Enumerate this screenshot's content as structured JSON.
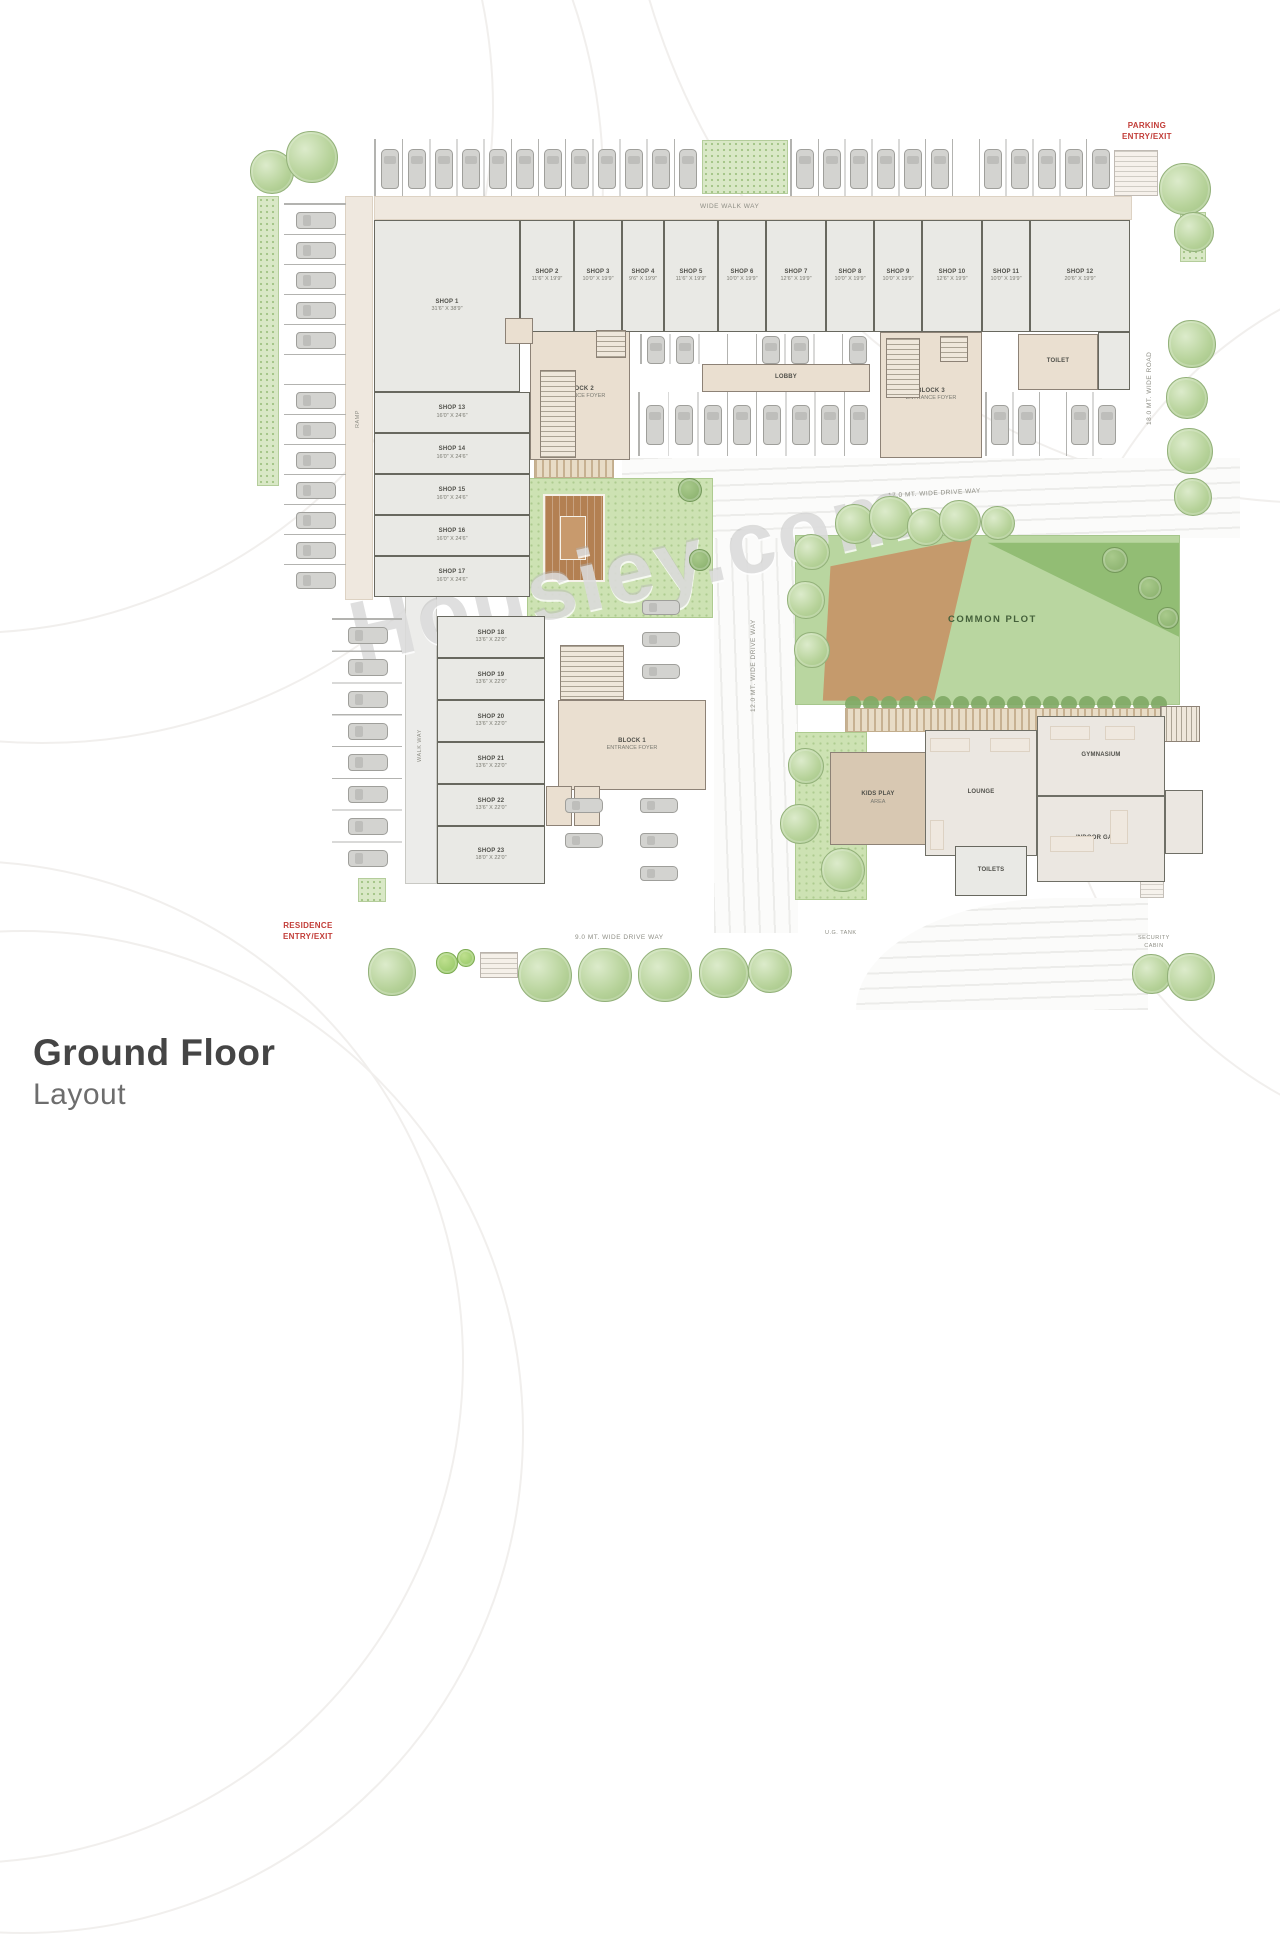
{
  "header": {
    "title": "Ground Floor",
    "subtitle": "Layout"
  },
  "watermark": "Housiey.com",
  "annotations": {
    "entry_top_right_line1": "PARKING",
    "entry_top_right_line2": "ENTRY/EXIT",
    "entry_bottom_left_line1": "RESIDENCE",
    "entry_bottom_left_line2": "ENTRY/EXIT",
    "walkway_top": "WIDE WALK WAY",
    "drive_17": "17.0 MT. WIDE DRIVE WAY",
    "drive_12": "12.0 MT. WIDE DRIVE WAY",
    "drive_9": "9.0 MT. WIDE DRIVE WAY",
    "road_18": "18.0 MT. WIDE ROAD",
    "ramp_left": "RAMP",
    "walk_left": "WALK WAY",
    "ug_tank": "U.G. TANK",
    "security_line1": "SECURITY",
    "security_line2": "CABIN",
    "common_plot": "COMMON PLOT"
  },
  "rooms": {
    "shop1": {
      "name": "SHOP 1",
      "dims": "31'6\" X 38'9\""
    },
    "shop2": {
      "name": "SHOP 2",
      "dims": "11'6\" X 19'9\""
    },
    "shop3": {
      "name": "SHOP 3",
      "dims": "10'0\" X 19'9\""
    },
    "shop4": {
      "name": "SHOP 4",
      "dims": "9'6\" X 19'9\""
    },
    "shop5": {
      "name": "SHOP 5",
      "dims": "11'6\" X 19'9\""
    },
    "shop6": {
      "name": "SHOP 6",
      "dims": "10'0\" X 19'9\""
    },
    "shop7": {
      "name": "SHOP 7",
      "dims": "12'6\" X 19'9\""
    },
    "shop8": {
      "name": "SHOP 8",
      "dims": "10'0\" X 19'9\""
    },
    "shop9": {
      "name": "SHOP 9",
      "dims": "10'0\" X 19'9\""
    },
    "shop10": {
      "name": "SHOP 10",
      "dims": "12'6\" X 19'9\""
    },
    "shop11": {
      "name": "SHOP 11",
      "dims": "10'0\" X 19'9\""
    },
    "shop12": {
      "name": "SHOP 12",
      "dims": "20'6\" X 19'9\""
    },
    "shop13": {
      "name": "SHOP 13",
      "dims": "16'0\" X 24'6\""
    },
    "shop14": {
      "name": "SHOP 14",
      "dims": "16'0\" X 24'6\""
    },
    "shop15": {
      "name": "SHOP 15",
      "dims": "16'0\" X 24'6\""
    },
    "shop16": {
      "name": "SHOP 16",
      "dims": "16'0\" X 24'6\""
    },
    "shop17": {
      "name": "SHOP 17",
      "dims": "16'0\" X 24'6\""
    },
    "shop18": {
      "name": "SHOP 18",
      "dims": "13'6\" X 22'0\""
    },
    "shop19": {
      "name": "SHOP 19",
      "dims": "13'6\" X 22'0\""
    },
    "shop20": {
      "name": "SHOP 20",
      "dims": "13'6\" X 22'0\""
    },
    "shop21": {
      "name": "SHOP 21",
      "dims": "13'6\" X 22'0\""
    },
    "shop22": {
      "name": "SHOP 22",
      "dims": "13'6\" X 22'0\""
    },
    "shop23": {
      "name": "SHOP 23",
      "dims": "18'0\" X 22'0\""
    },
    "block2": {
      "name": "BLOCK 2",
      "dims": "ENTRANCE FOYER"
    },
    "block3": {
      "name": "BLOCK 3",
      "dims": "ENTRANCE FOYER"
    },
    "block1": {
      "name": "BLOCK 1",
      "dims": "ENTRANCE FOYER"
    },
    "lobby": {
      "name": "LOBBY",
      "dims": ""
    },
    "toilet": {
      "name": "TOILET",
      "dims": ""
    },
    "kids": {
      "name": "KIDS PLAY",
      "dims": "AREA"
    },
    "lounge": {
      "name": "LOUNGE",
      "dims": ""
    },
    "gym": {
      "name": "GYMNASIUM",
      "dims": ""
    },
    "games": {
      "name": "INDOOR GAMES",
      "dims": ""
    },
    "wc": {
      "name": "TOILETS",
      "dims": ""
    }
  },
  "colors": {
    "accent_red": "#c23d38",
    "plot_green": "#b9d6a0",
    "wedge_brown": "#c59a6c",
    "core_beige": "#eadfd0",
    "room_gray": "#e9e9e5"
  }
}
